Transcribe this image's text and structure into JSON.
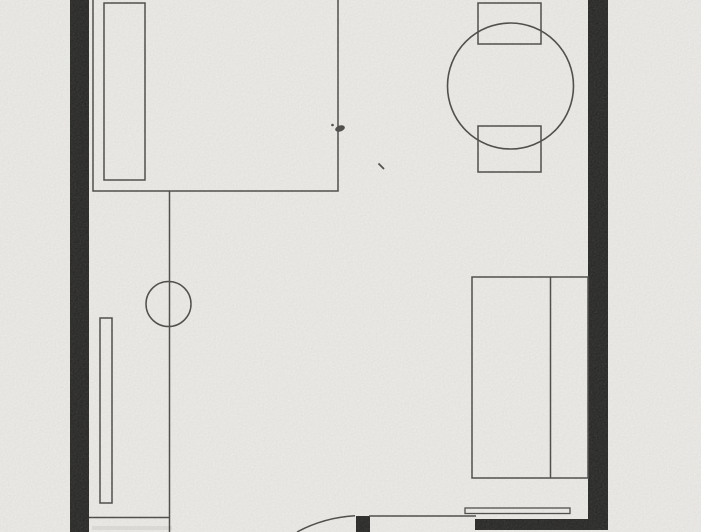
{
  "floorplan": {
    "canvas": {
      "width": 701,
      "height": 532
    },
    "colors": {
      "paper": "#f2f1ed",
      "ink": "#3f3e3c",
      "wall": "#191918",
      "smudge": "#d7d4cf"
    },
    "elements": [
      {
        "name": "scan-smudge",
        "type": "rect",
        "x": 92,
        "y": 526,
        "w": 80,
        "h": 4,
        "fill": "smudge",
        "stroke": "none",
        "opacity": 0.55
      },
      {
        "name": "wall-left",
        "type": "rect",
        "x": 70,
        "y": 0,
        "w": 19,
        "h": 532,
        "fill": "wall",
        "stroke": "none"
      },
      {
        "name": "wall-right",
        "type": "rect",
        "x": 588,
        "y": 0,
        "w": 20,
        "h": 530,
        "fill": "wall",
        "stroke": "none"
      },
      {
        "name": "wall-bottom-right",
        "type": "rect",
        "x": 475,
        "y": 519,
        "w": 117,
        "h": 11,
        "fill": "wall",
        "stroke": "none"
      },
      {
        "name": "door-jamb",
        "type": "rect",
        "x": 356,
        "y": 516,
        "w": 14,
        "h": 16,
        "fill": "wall",
        "stroke": "none"
      },
      {
        "name": "bed-top-outline",
        "type": "path",
        "d": "M 93 -2 L 93 191 L 338 191 L 338 -2"
      },
      {
        "name": "bed-top-headboard",
        "type": "rect",
        "x": 104,
        "y": 3,
        "w": 41,
        "h": 177
      },
      {
        "name": "dining-table-top",
        "type": "circle",
        "cx": 510.5,
        "cy": 86,
        "r": 63,
        "sw": 1.6
      },
      {
        "name": "chair-top",
        "type": "rect",
        "x": 478,
        "y": 3,
        "w": 63,
        "h": 41
      },
      {
        "name": "chair-bottom",
        "type": "rect",
        "x": 478,
        "y": 126,
        "w": 63,
        "h": 46
      },
      {
        "name": "partition-line",
        "type": "line",
        "x1": 169.5,
        "y1": 191,
        "x2": 169.5,
        "y2": 532
      },
      {
        "name": "fixture-circle",
        "type": "circle",
        "cx": 168.5,
        "cy": 304,
        "r": 22.5
      },
      {
        "name": "radiator",
        "type": "rect",
        "x": 100,
        "y": 318,
        "w": 12,
        "h": 185
      },
      {
        "name": "counter-edge-line",
        "type": "line",
        "x1": 89,
        "y1": 517.5,
        "x2": 169.5,
        "y2": 517.5
      },
      {
        "name": "bed-bottom-outline",
        "type": "rect",
        "x": 472,
        "y": 277,
        "w": 116,
        "h": 201
      },
      {
        "name": "bed-bottom-divider",
        "type": "line",
        "x1": 550.5,
        "y1": 277,
        "x2": 550.5,
        "y2": 478
      },
      {
        "name": "wall-shelf",
        "type": "rect",
        "x": 465,
        "y": 508,
        "w": 105,
        "h": 5.5,
        "sw": 1.3
      },
      {
        "name": "doorway-head-line",
        "type": "line",
        "x1": 369,
        "y1": 516,
        "x2": 476,
        "y2": 516,
        "sw": 1.4
      },
      {
        "name": "door-swing-arc",
        "type": "path",
        "d": "M 297 532 C 313 523.5 333 517 355 515.8"
      },
      {
        "name": "ink-mark-blob",
        "type": "ellipse",
        "cx": 340,
        "cy": 128.5,
        "rx": 5,
        "ry": 3,
        "rot": -18,
        "fill": "ink",
        "stroke": "none"
      },
      {
        "name": "ink-mark-dot",
        "type": "circle",
        "cx": 332.5,
        "cy": 125,
        "r": 1.3,
        "fill": "ink",
        "stroke": "none"
      },
      {
        "name": "ink-mark-dash",
        "type": "line",
        "x1": 378.5,
        "y1": 163.5,
        "x2": 384,
        "y2": 169,
        "sw": 1.8
      }
    ]
  }
}
